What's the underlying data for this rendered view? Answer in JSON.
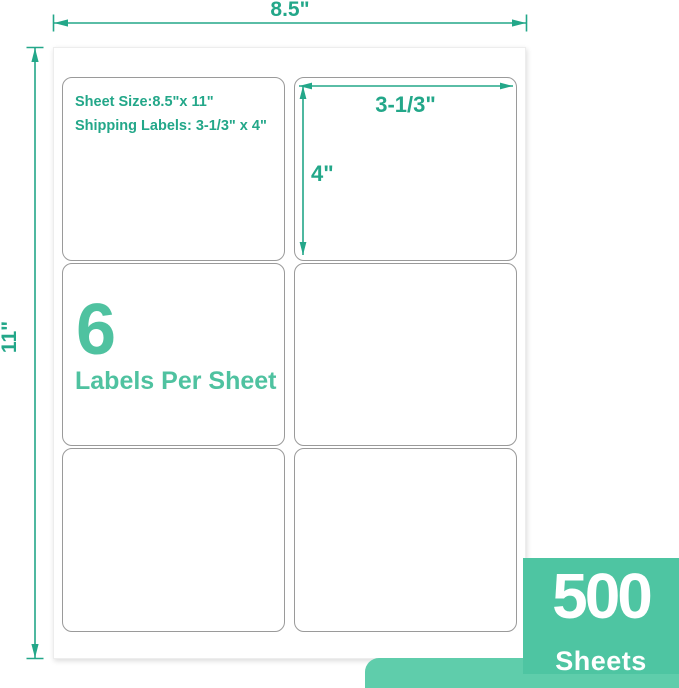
{
  "colors": {
    "dimension_green": "#23a789",
    "display_green": "#4fc2a0",
    "badge_bg": "#4ec5a2",
    "strip_bg": "#5fcdab",
    "label_border": "#9a9a9a"
  },
  "dimensions": {
    "sheet_width": "8.5\"",
    "sheet_height": "11\"",
    "label_width": "3-1/3\"",
    "label_height": "4\""
  },
  "info_label": {
    "line1": "Sheet Size:8.5\"x 11\"",
    "line2": "Shipping Labels: 3-1/3\" x 4\""
  },
  "count_label": {
    "number": "6",
    "caption": "Labels Per Sheet"
  },
  "badge": {
    "number": "500",
    "caption": "Sheets"
  }
}
